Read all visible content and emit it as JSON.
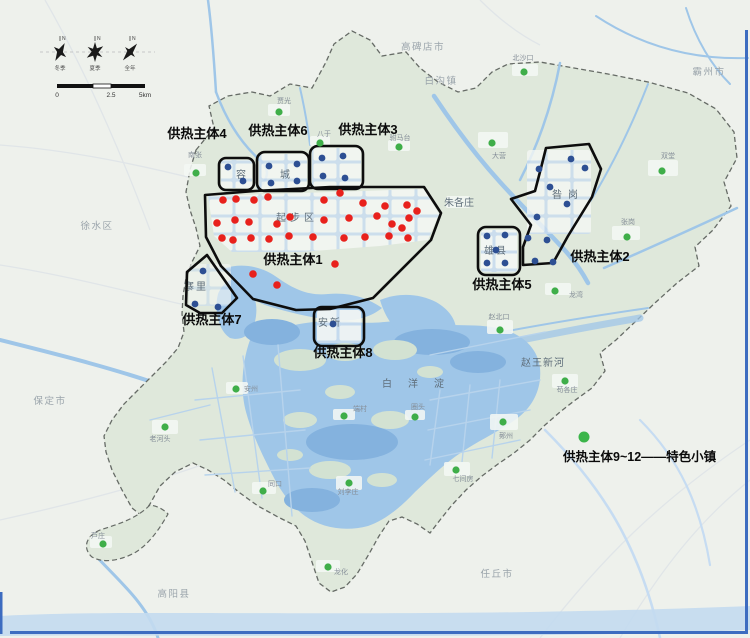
{
  "frame": {
    "border_color": "#3d6cc0"
  },
  "compass": {
    "north_mark": "N",
    "labels": [
      "冬季",
      "夏季",
      "全年"
    ]
  },
  "scalebar": {
    "ticks": [
      "0",
      "2.5",
      "5km"
    ]
  },
  "legend": {
    "text": "供热主体9~12——特色小镇",
    "dot_color": "#3bb54a"
  },
  "colors": {
    "red": "#e8211c",
    "blue": "#2d4f93",
    "green": "#3fae49",
    "outline": "#0d0d0d",
    "water": "#9fc6e8",
    "land": "#dfe8db",
    "outside": "#eef1ec"
  },
  "map": {
    "cities": [
      {
        "text": "高碑店市",
        "x": 423,
        "y": 50
      },
      {
        "text": "霸州市",
        "x": 709,
        "y": 75
      },
      {
        "text": "徐水区",
        "x": 97,
        "y": 229
      },
      {
        "text": "保定市",
        "x": 50,
        "y": 404
      },
      {
        "text": "高阳县",
        "x": 174,
        "y": 597
      },
      {
        "text": "任丘市",
        "x": 497,
        "y": 577
      },
      {
        "text": "白沟镇",
        "x": 441,
        "y": 84
      }
    ],
    "areas": [
      {
        "text": "起步区",
        "x": 297,
        "y": 221,
        "ls": 4,
        "size": 10
      },
      {
        "text": "容城",
        "x": 280,
        "y": 178,
        "ls": 34,
        "size": 10
      },
      {
        "text": "昝岗",
        "x": 568,
        "y": 198,
        "ls": 6,
        "size": 11
      },
      {
        "text": "雄县",
        "x": 496,
        "y": 254,
        "ls": 2,
        "size": 10
      },
      {
        "text": "安新",
        "x": 330,
        "y": 326,
        "ls": 2,
        "size": 10
      },
      {
        "text": "寨里",
        "x": 196,
        "y": 290,
        "ls": 2,
        "size": 10
      },
      {
        "text": "白洋淀",
        "x": 421,
        "y": 387,
        "ls": 16,
        "size": 11
      },
      {
        "text": "朱各庄",
        "x": 459,
        "y": 206,
        "ls": 0,
        "size": 7
      },
      {
        "text": "赵王新河",
        "x": 543,
        "y": 366,
        "ls": 1,
        "size": 6
      }
    ],
    "zones": [
      {
        "label": "供热主体1",
        "lx": 293,
        "ly": 264
      },
      {
        "label": "供热主体2",
        "lx": 600,
        "ly": 261
      },
      {
        "label": "供热主体3",
        "lx": 368,
        "ly": 134
      },
      {
        "label": "供热主体4",
        "lx": 197,
        "ly": 138
      },
      {
        "label": "供热主体5",
        "lx": 502,
        "ly": 289
      },
      {
        "label": "供热主体6",
        "lx": 278,
        "ly": 135
      },
      {
        "label": "供热主体7",
        "lx": 212,
        "ly": 324
      },
      {
        "label": "供热主体8",
        "lx": 343,
        "ly": 357
      }
    ],
    "towns": [
      {
        "name": "北沙口",
        "x": 524,
        "y": 72,
        "lx": 523,
        "ly": 60
      },
      {
        "name": "贾光",
        "x": 279,
        "y": 112,
        "lx": 284,
        "ly": 103
      },
      {
        "name": "八于",
        "x": 320,
        "y": 143,
        "lx": 324,
        "ly": 136
      },
      {
        "name": "驸马台",
        "x": 399,
        "y": 147,
        "lx": 400,
        "ly": 140
      },
      {
        "name": "南张",
        "x": 196,
        "y": 173,
        "lx": 195,
        "ly": 157
      },
      {
        "name": "大营",
        "x": 492,
        "y": 143,
        "lx": 499,
        "ly": 158
      },
      {
        "name": "双堂",
        "x": 662,
        "y": 171,
        "lx": 668,
        "ly": 158
      },
      {
        "name": "张岗",
        "x": 627,
        "y": 237,
        "lx": 628,
        "ly": 224
      },
      {
        "name": "龙湾",
        "x": 555,
        "y": 291,
        "lx": 576,
        "ly": 297
      },
      {
        "name": "赵北口",
        "x": 500,
        "y": 330,
        "lx": 499,
        "ly": 319
      },
      {
        "name": "安州",
        "x": 236,
        "y": 389,
        "lx": 251,
        "ly": 391
      },
      {
        "name": "端村",
        "x": 344,
        "y": 416,
        "lx": 360,
        "ly": 411
      },
      {
        "name": "圈头",
        "x": 415,
        "y": 417,
        "lx": 418,
        "ly": 409
      },
      {
        "name": "鄚州",
        "x": 503,
        "y": 422,
        "lx": 506,
        "ly": 438
      },
      {
        "name": "苟各庄",
        "x": 565,
        "y": 381,
        "lx": 567,
        "ly": 392
      },
      {
        "name": "七间房",
        "x": 456,
        "y": 470,
        "lx": 463,
        "ly": 481
      },
      {
        "name": "刘李庄",
        "x": 349,
        "y": 483,
        "lx": 348,
        "ly": 494
      },
      {
        "name": "同口",
        "x": 263,
        "y": 491,
        "lx": 275,
        "ly": 486
      },
      {
        "name": "老河头",
        "x": 165,
        "y": 427,
        "lx": 160,
        "ly": 441
      },
      {
        "name": "芦庄",
        "x": 103,
        "y": 544,
        "lx": 98,
        "ly": 538
      },
      {
        "name": "龙化",
        "x": 328,
        "y": 567,
        "lx": 341,
        "ly": 574
      }
    ],
    "red_dots": [
      [
        223,
        200
      ],
      [
        236,
        199
      ],
      [
        254,
        200
      ],
      [
        268,
        197
      ],
      [
        324,
        200
      ],
      [
        340,
        193
      ],
      [
        363,
        203
      ],
      [
        385,
        206
      ],
      [
        407,
        205
      ],
      [
        417,
        211
      ],
      [
        217,
        223
      ],
      [
        235,
        220
      ],
      [
        249,
        222
      ],
      [
        277,
        224
      ],
      [
        290,
        217
      ],
      [
        324,
        220
      ],
      [
        349,
        218
      ],
      [
        377,
        216
      ],
      [
        392,
        224
      ],
      [
        409,
        218
      ],
      [
        222,
        238
      ],
      [
        233,
        240
      ],
      [
        251,
        238
      ],
      [
        269,
        239
      ],
      [
        289,
        236
      ],
      [
        313,
        237
      ],
      [
        344,
        238
      ],
      [
        365,
        237
      ],
      [
        389,
        236
      ],
      [
        402,
        228
      ],
      [
        408,
        238
      ],
      [
        253,
        274
      ],
      [
        277,
        285
      ],
      [
        335,
        264
      ]
    ],
    "blue_dots": [
      [
        228,
        167
      ],
      [
        243,
        181
      ],
      [
        269,
        166
      ],
      [
        297,
        164
      ],
      [
        271,
        183
      ],
      [
        297,
        181
      ],
      [
        322,
        158
      ],
      [
        343,
        156
      ],
      [
        323,
        176
      ],
      [
        345,
        178
      ],
      [
        487,
        236
      ],
      [
        505,
        235
      ],
      [
        496,
        250
      ],
      [
        487,
        263
      ],
      [
        505,
        263
      ],
      [
        333,
        324
      ],
      [
        203,
        271
      ],
      [
        195,
        304
      ],
      [
        218,
        307
      ],
      [
        571,
        159
      ],
      [
        539,
        169
      ],
      [
        585,
        168
      ],
      [
        550,
        187
      ],
      [
        567,
        204
      ],
      [
        537,
        217
      ],
      [
        528,
        238
      ],
      [
        547,
        240
      ],
      [
        535,
        261
      ],
      [
        553,
        262
      ]
    ]
  }
}
